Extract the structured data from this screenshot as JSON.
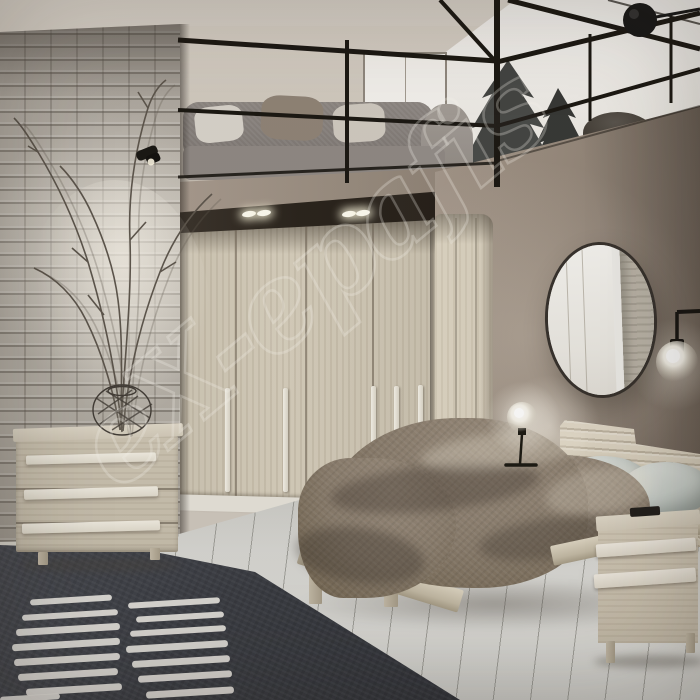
{
  "meta": {
    "kind": "interior photograph",
    "subject": "modern bedroom with loft mezzanine, corner wardrobe and double bed"
  },
  "watermark": {
    "text": "eX-epafis"
  },
  "objects": {
    "loft_sofa": "grey fabric sofa with cushions on the mezzanine",
    "railing": "black metal and glass loft railing",
    "pine_art": "dark pine trees seen behind the glass railing",
    "wardrobe": "light ash corner wardrobe with six tall doors and white bar handles",
    "ceiling_spots": "recessed spotlights above the wardrobe",
    "mirror": "oval mirror on taupe wall reflecting the wardrobe and brick wall",
    "wall_lamp": "black arm wall lamp with glowing glass globe",
    "disc_sconce": "black disc spotlight at top right",
    "bed": "light wood double bed with brown textured duvet and sage-grey pillows",
    "nightstand": "light wood nightstand with two white drawer strips",
    "table_lamp": "glass globe table lamp with black stem",
    "dresser": "three-drawer light wood dresser with white bar handles",
    "vase": "wire basket vase with tall dry branches",
    "brick_wall": "whitewashed grey brick wall with black spotlight",
    "rug": "dark charcoal rug with rows of white dashes",
    "floor": "whitewashed wood plank floor laid diagonally"
  },
  "palette": {
    "ceiling": "#d2cbc1",
    "brick": "#b5b0a7",
    "mezzanine_wall": "#d1cabf",
    "right_wall": "#8b7e72",
    "wardrobe_wood": "#d2cab8",
    "handle_white": "#f1ede2",
    "railing_black": "#17140f",
    "duvet_brown": "#867969",
    "pillow_sage": "#ccd3cd",
    "bed_wood": "#d8d0bd",
    "rug_dark": "#383b42",
    "rug_stripe": "#e9e7e2",
    "floor": "#d8d8d4",
    "window_white": "#f4f2ee"
  }
}
